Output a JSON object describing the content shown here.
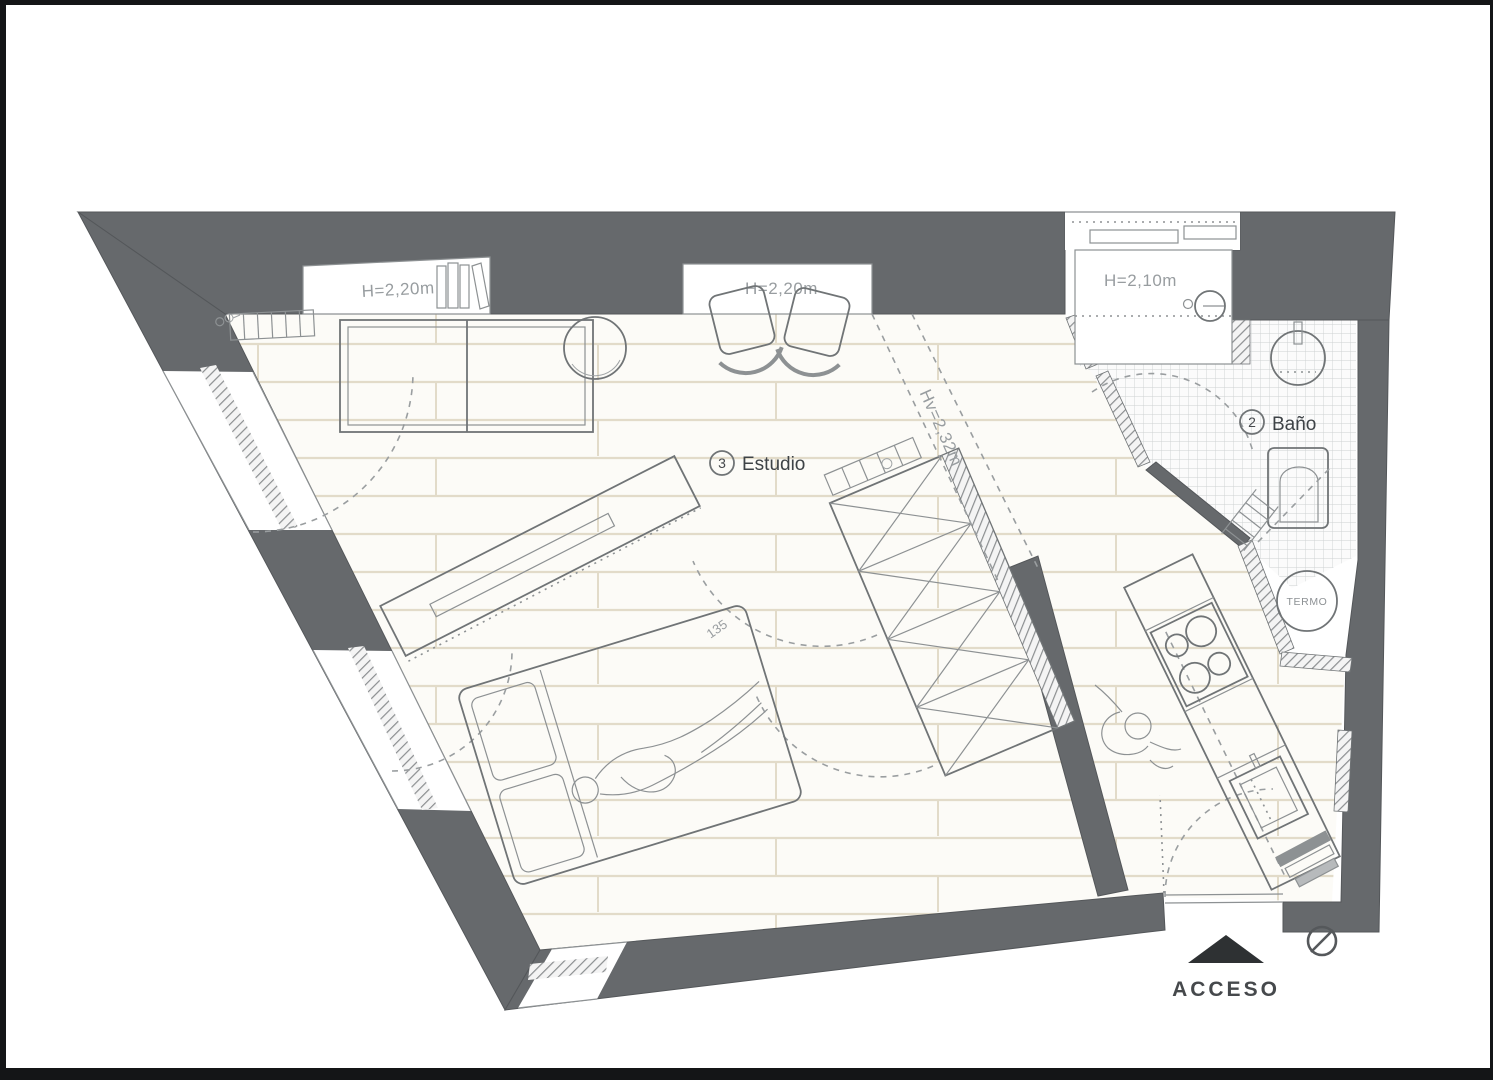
{
  "plan": {
    "type": "apartment floor plan",
    "labels": {
      "left_shelf_height": "H=2,20m",
      "center_niche_height": "H=2,20m",
      "storage_height": "H=2,10m",
      "window_beam_height": "Hv=2,32m"
    },
    "rooms": {
      "studio": {
        "number": "3",
        "name": "Estudio"
      },
      "bathroom": {
        "number": "2",
        "name": "Baño"
      }
    },
    "equipment": {
      "water_heater": "TERMO"
    },
    "dimensions": {
      "bed_width": "135"
    },
    "entrance": {
      "label": "ACCESO"
    }
  },
  "colors": {
    "wall": "#66696c",
    "frame": "#141517",
    "arrow": "#2e3133",
    "floor_line": "#e2dbc9",
    "tile_line": "#cdd0d2",
    "outline": "#707476",
    "text_gray": "#989da0",
    "text_dark": "#3e4347"
  }
}
